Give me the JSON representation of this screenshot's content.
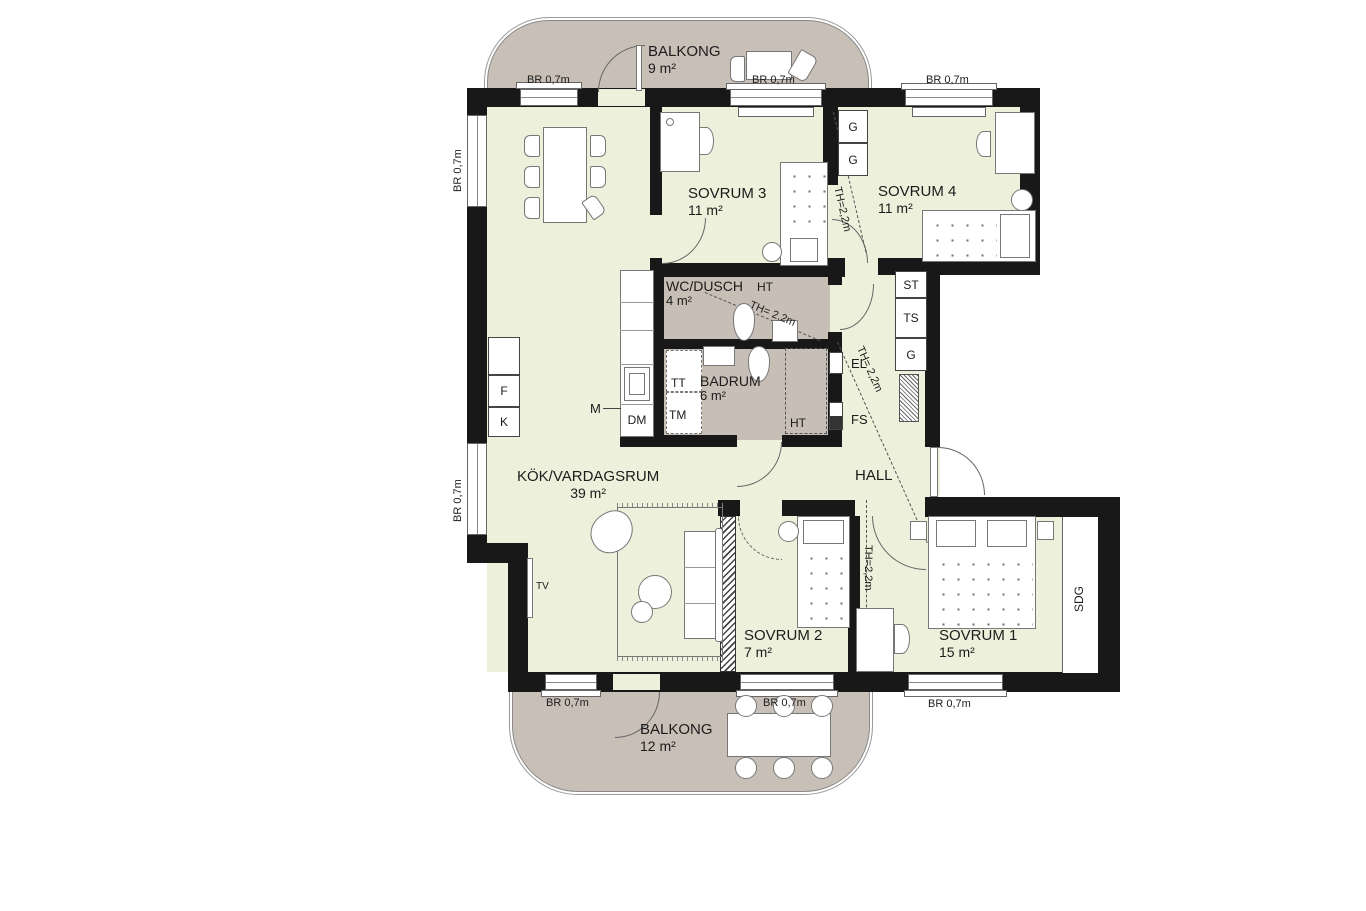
{
  "colors": {
    "floor_fill": "#edf0da",
    "wet_and_balcony_fill": "#c7beb5",
    "wall": "#181818"
  },
  "rooms": {
    "balkong_top": {
      "name": "BALKONG",
      "area": "9 m²"
    },
    "sovrum3": {
      "name": "SOVRUM 3",
      "area": "11 m²"
    },
    "sovrum4": {
      "name": "SOVRUM 4",
      "area": "11 m²"
    },
    "wc_dusch": {
      "name": "WC/DUSCH",
      "area": "4 m²"
    },
    "badrum": {
      "name": "BADRUM",
      "area": "6 m²"
    },
    "kok": {
      "name": "KÖK/VARDAGSRUM",
      "area": "39 m²"
    },
    "hall": {
      "name": "HALL"
    },
    "sovrum2": {
      "name": "SOVRUM 2",
      "area": "7 m²"
    },
    "sovrum1": {
      "name": "SOVRUM 1",
      "area": "15 m²"
    },
    "balkong_bottom": {
      "name": "BALKONG",
      "area": "12 m²"
    }
  },
  "labels": {
    "br": "BR 0,7m",
    "th": "TH=2,2m",
    "th_spaced": "TH= 2,2m",
    "tv": "TV",
    "m": "M",
    "dm": "DM",
    "f": "F",
    "k": "K",
    "tt": "TT",
    "tm": "TM",
    "ht": "HT",
    "el": "EL",
    "fs": "FS",
    "st": "ST",
    "ts": "TS",
    "g": "G",
    "sdg": "SDG"
  }
}
